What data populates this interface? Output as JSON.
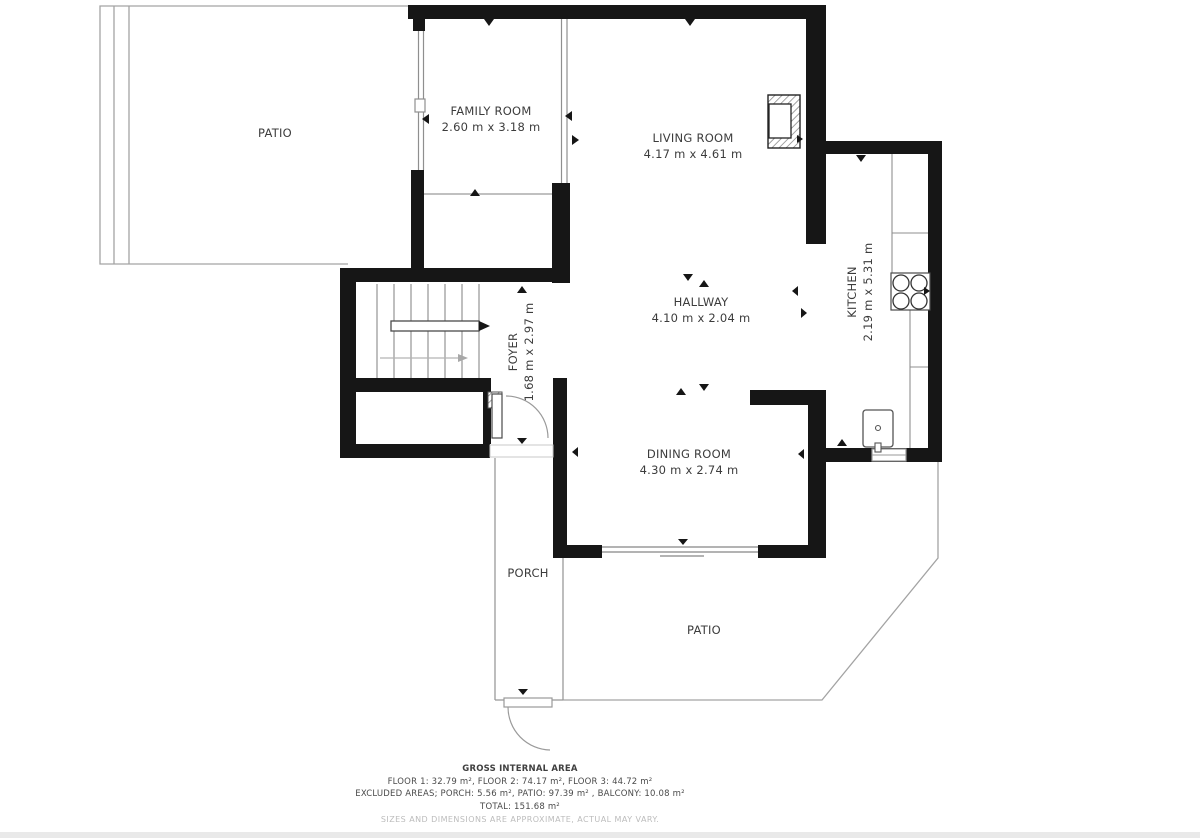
{
  "plan": {
    "rooms": {
      "patio_upper": {
        "name": "PATIO"
      },
      "family_room": {
        "name": "FAMILY ROOM",
        "dims": "2.60 m x 3.18 m"
      },
      "living_room": {
        "name": "LIVING ROOM",
        "dims": "4.17 m x 4.61 m"
      },
      "foyer": {
        "name": "FOYER",
        "dims": "1.68 m x 2.97 m"
      },
      "hallway": {
        "name": "HALLWAY",
        "dims": "4.10 m x 2.04 m"
      },
      "kitchen": {
        "name": "KITCHEN",
        "dims": "2.19 m x 5.31 m"
      },
      "dining_room": {
        "name": "DINING ROOM",
        "dims": "4.30 m x 2.74 m"
      },
      "porch": {
        "name": "PORCH"
      },
      "patio_lower": {
        "name": "PATIO"
      }
    },
    "footer": {
      "title": "GROSS INTERNAL AREA",
      "floors": "FLOOR 1: 32.79 m², FLOOR 2: 74.17 m², FLOOR 3: 44.72 m²",
      "excluded": "EXCLUDED AREAS; PORCH: 5.56 m², PATIO: 97.39 m² , BALCONY: 10.08 m²",
      "total": "TOTAL: 151.68 m²",
      "disclaimer": "SIZES AND DIMENSIONS ARE APPROXIMATE, ACTUAL MAY VARY."
    },
    "colors": {
      "wall": "#161616",
      "thin_line": "#999999",
      "label_text": "#3c3c3c",
      "muted_text": "#bcbcbc",
      "background": "#ffffff"
    }
  }
}
